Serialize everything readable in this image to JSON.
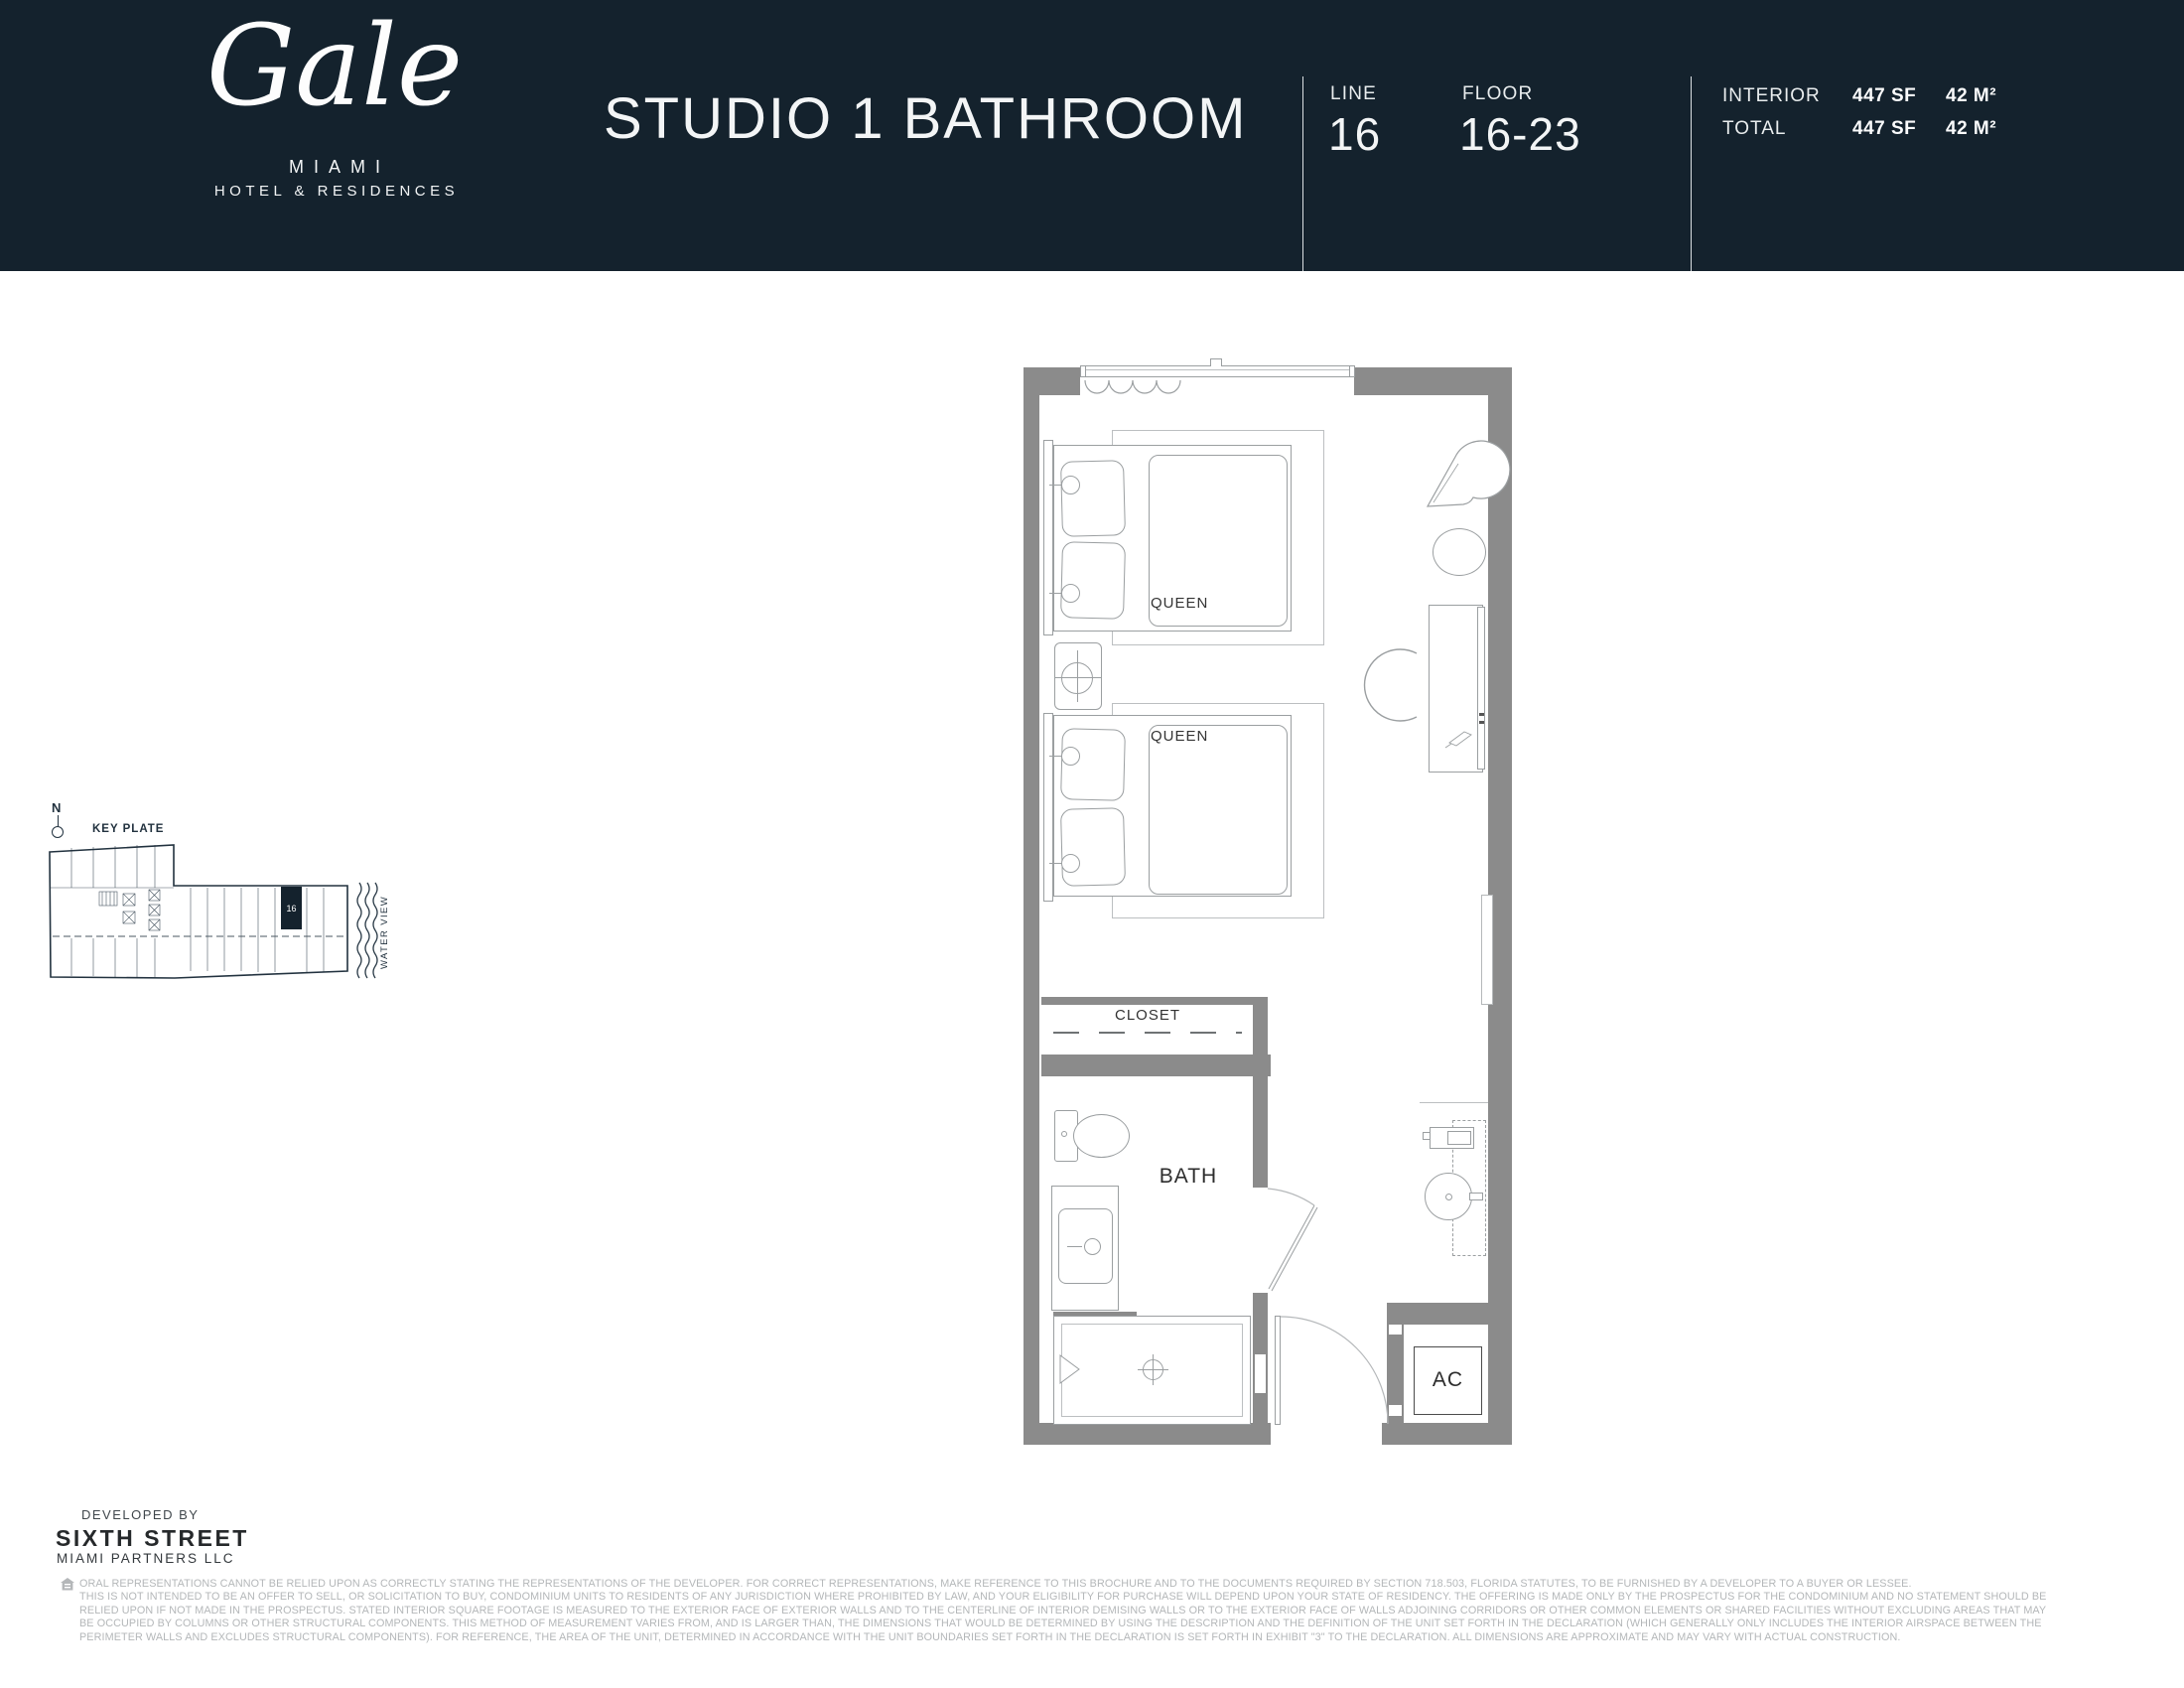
{
  "colors": {
    "header_bg": "#14222d",
    "wall_gray": "#8b8b8b",
    "accent_navy": "#22323f",
    "disclaimer_gray": "#b4b7b9"
  },
  "header": {
    "brand": {
      "name": "Gale",
      "city": "MIAMI",
      "tagline": "HOTEL & RESIDENCES"
    },
    "title": "STUDIO 1 BATHROOM",
    "line": {
      "label": "LINE",
      "value": "16"
    },
    "floor": {
      "label": "FLOOR",
      "value": "16-23"
    },
    "area": {
      "rows": [
        {
          "label": "INTERIOR",
          "sf": "447 SF",
          "m2": "42 M²"
        },
        {
          "label": "TOTAL",
          "sf": "447 SF",
          "m2": "42 M²"
        }
      ]
    }
  },
  "key_plate": {
    "north_label": "N",
    "title": "KEY PLATE",
    "unit_number": "16",
    "water_view_label": "WATER VIEW"
  },
  "floor_plan": {
    "labels": {
      "bed1": "QUEEN",
      "bed2": "QUEEN",
      "closet": "CLOSET",
      "bath": "BATH",
      "ac": "AC"
    }
  },
  "footer": {
    "developed_by": "DEVELOPED BY",
    "developer_name": "SIXTH STREET",
    "developer_sub": "MIAMI PARTNERS LLC",
    "disclaimer_lines": [
      "ORAL REPRESENTATIONS CANNOT BE RELIED UPON AS CORRECTLY STATING THE REPRESENTATIONS OF THE DEVELOPER. FOR CORRECT REPRESENTATIONS, MAKE REFERENCE TO THIS BROCHURE AND TO THE DOCUMENTS REQUIRED BY SECTION 718.503, FLORIDA STATUTES, TO BE FURNISHED BY A DEVELOPER TO A BUYER OR LESSEE.",
      "THIS IS NOT INTENDED TO BE AN OFFER TO SELL, OR SOLICITATION TO BUY, CONDOMINIUM UNITS TO RESIDENTS OF ANY JURISDICTION WHERE PROHIBITED BY LAW, AND YOUR ELIGIBILITY FOR PURCHASE WILL DEPEND UPON YOUR STATE OF RESIDENCY. THE OFFERING IS MADE ONLY BY THE PROSPECTUS FOR THE CONDOMINIUM AND NO STATEMENT SHOULD BE",
      "RELIED UPON IF NOT MADE IN THE PROSPECTUS. STATED INTERIOR SQUARE FOOTAGE IS MEASURED TO THE EXTERIOR FACE OF EXTERIOR WALLS AND TO THE CENTERLINE OF INTERIOR DEMISING WALLS OR TO THE EXTERIOR FACE OF WALLS ADJOINING CORRIDORS OR OTHER COMMON ELEMENTS OR SHARED FACILITIES WITHOUT EXCLUDING AREAS THAT MAY",
      "BE OCCUPIED BY COLUMNS OR OTHER STRUCTURAL COMPONENTS. THIS METHOD OF MEASUREMENT VARIES FROM, AND IS LARGER THAN, THE DIMENSIONS THAT WOULD BE DETERMINED BY USING THE DESCRIPTION AND THE DEFINITION OF THE UNIT SET FORTH IN THE DECLARATION (WHICH GENERALLY ONLY INCLUDES THE INTERIOR AIRSPACE BETWEEN THE",
      "PERIMETER WALLS AND EXCLUDES STRUCTURAL COMPONENTS). FOR REFERENCE, THE AREA OF THE UNIT, DETERMINED IN ACCORDANCE WITH THE UNIT BOUNDARIES SET FORTH IN THE DECLARATION IS SET FORTH IN EXHIBIT \"3\" TO THE DECLARATION. ALL DIMENSIONS ARE APPROXIMATE AND MAY VARY WITH ACTUAL CONSTRUCTION."
    ]
  }
}
